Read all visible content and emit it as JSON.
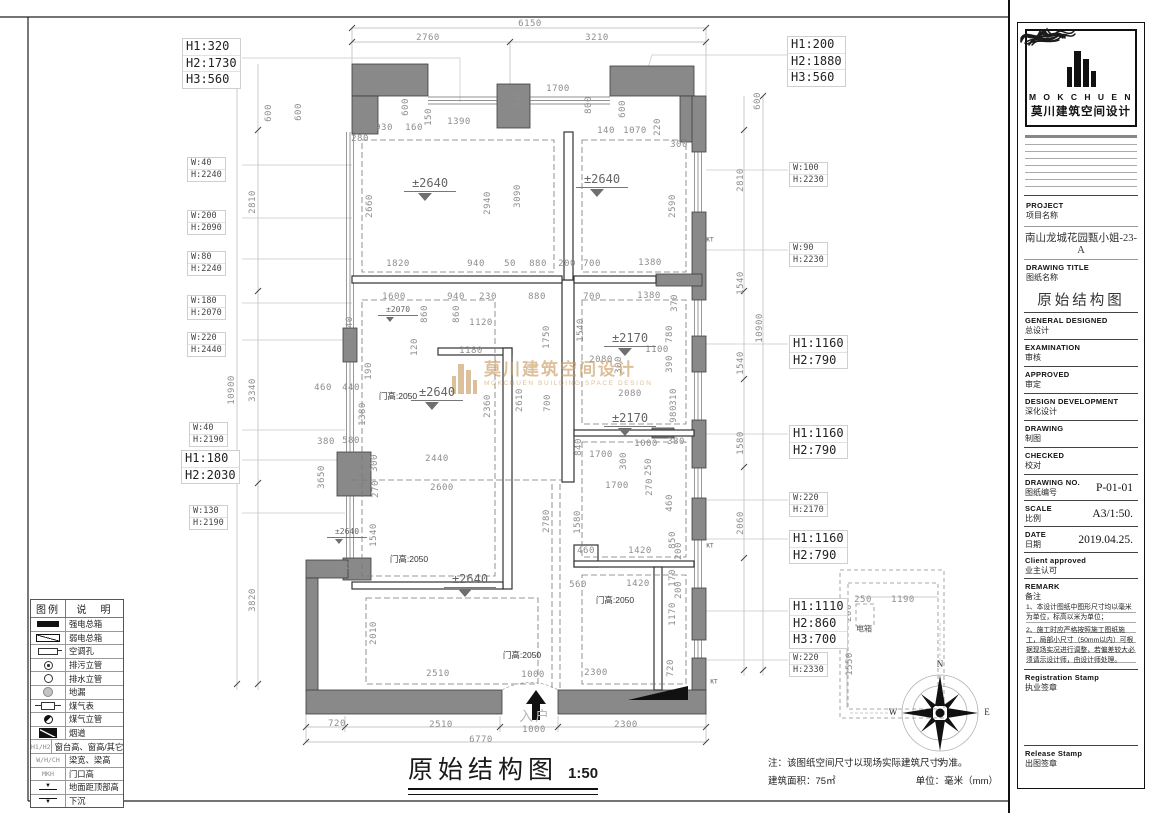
{
  "footer": {
    "title": "原始结构图",
    "scale": "1:50",
    "note": "注：该图纸空间尺寸以现场实际建筑尺寸为准。",
    "area": "建筑面积：75㎡",
    "unit": "单位：毫米（mm）"
  },
  "watermark": {
    "zh": "莫川建筑空间设计",
    "en": "MOKCHUEN BUILDING SPACE DESIGN",
    "color": "#c79b5e"
  },
  "legend": {
    "headers": [
      "图例",
      "说　明"
    ],
    "rows": [
      {
        "sym": "solid",
        "label": "强电总箱"
      },
      {
        "sym": "hatch",
        "label": "弱电总箱"
      },
      {
        "sym": "kt",
        "label": "空调孔"
      },
      {
        "sym": "cdot",
        "label": "排污立管"
      },
      {
        "sym": "c",
        "label": "排水立管"
      },
      {
        "sym": "cgray",
        "label": "地漏"
      },
      {
        "sym": "gas",
        "label": "煤气表"
      },
      {
        "sym": "chalf",
        "label": "煤气立管"
      },
      {
        "sym": "flue",
        "label": "烟道"
      },
      {
        "sym": "text",
        "symtext": "H1/H2",
        "label": "窗台高、窗高/其它"
      },
      {
        "sym": "text",
        "symtext": "W/H/CH",
        "label": "梁宽、梁高"
      },
      {
        "sym": "text",
        "symtext": "MKH",
        "label": "门口高"
      },
      {
        "sym": "lvlup",
        "symtext": "▼",
        "label": "地面距顶部高"
      },
      {
        "sym": "lvldn",
        "symtext": "▼",
        "label": "下沉"
      }
    ]
  },
  "title_block": {
    "brand_en": "M O K C H U E N",
    "brand_zh": "莫川建筑空间设计",
    "project_en": "PROJECT",
    "project_zh": "项目名称",
    "project_value": "南山龙城花园甄小姐-23-A",
    "drawing_title_en": "DRAWING TITLE",
    "drawing_title_zh": "图纸名称",
    "drawing_title_value": "原始结构图",
    "sign_fields": [
      {
        "en": "GENERAL  DESIGNED",
        "zh": "总设计"
      },
      {
        "en": "EXAMINATION",
        "zh": "审核"
      },
      {
        "en": "APPROVED",
        "zh": "审定"
      },
      {
        "en": "DESIGN DEVELOPMENT",
        "zh": "深化设计"
      },
      {
        "en": "DRAWING",
        "zh": "制图"
      },
      {
        "en": "CHECKED",
        "zh": "校对"
      }
    ],
    "drawing_no_en": "DRAWING NO.",
    "drawing_no_zh": "图纸编号",
    "drawing_no_value": "P-01-01",
    "scale_en": "SCALE",
    "scale_zh": "比例",
    "scale_value": "A3/1:50.",
    "date_en": "DATE",
    "date_zh": "日期",
    "date_value": "2019.04.25.",
    "client_en": "Client approved",
    "client_zh": "业主认可",
    "remark_en": "REMARK",
    "remark_zh": "备注",
    "remark_notes": [
      "1、本设计图纸中图形尺寸均以毫米为单位，标高以米为单位；",
      "2、施工时应严格按照施工图纸施工，局部小尺寸（50mm以内）可根据现场实况进行调整，若偏差较大必须请示设计师，由设计师处理。"
    ],
    "registration_en": "Registration Stamp",
    "registration_zh": "执业签章",
    "release_en": "Release Stamp",
    "release_zh": "出图签章"
  },
  "plan": {
    "compass": {
      "n": "N",
      "e": "E",
      "s": "S",
      "w": "W"
    },
    "dims": [
      {
        "t": "6150",
        "x": 530,
        "y": 24
      },
      {
        "t": "2760",
        "x": 428,
        "y": 38
      },
      {
        "t": "3210",
        "x": 597,
        "y": 38
      },
      {
        "t": "600",
        "x": 299,
        "y": 112,
        "r": 1
      },
      {
        "t": "280",
        "x": 360,
        "y": 139
      },
      {
        "t": "930",
        "x": 384,
        "y": 128
      },
      {
        "t": "160",
        "x": 414,
        "y": 128
      },
      {
        "t": "150",
        "x": 429,
        "y": 117,
        "r": 1
      },
      {
        "t": "1390",
        "x": 459,
        "y": 122
      },
      {
        "t": "600",
        "x": 406,
        "y": 107,
        "r": 1
      },
      {
        "t": "520",
        "x": 518,
        "y": 99,
        "r": 1
      },
      {
        "t": "1700",
        "x": 558,
        "y": 89
      },
      {
        "t": "800",
        "x": 589,
        "y": 105,
        "r": 1
      },
      {
        "t": "600",
        "x": 623,
        "y": 109,
        "r": 1
      },
      {
        "t": "140",
        "x": 606,
        "y": 131
      },
      {
        "t": "1070",
        "x": 635,
        "y": 131
      },
      {
        "t": "220",
        "x": 658,
        "y": 127,
        "r": 1
      },
      {
        "t": "300",
        "x": 679,
        "y": 145
      },
      {
        "t": "2660",
        "x": 370,
        "y": 206,
        "r": 1
      },
      {
        "t": "2940",
        "x": 488,
        "y": 203,
        "r": 1
      },
      {
        "t": "3090",
        "x": 518,
        "y": 196,
        "r": 1
      },
      {
        "t": "2590",
        "x": 673,
        "y": 206,
        "r": 1
      },
      {
        "t": "1820",
        "x": 398,
        "y": 264
      },
      {
        "t": "940",
        "x": 476,
        "y": 264
      },
      {
        "t": "50",
        "x": 510,
        "y": 264
      },
      {
        "t": "880",
        "x": 538,
        "y": 264
      },
      {
        "t": "200",
        "x": 567,
        "y": 264
      },
      {
        "t": "700",
        "x": 592,
        "y": 264
      },
      {
        "t": "1380",
        "x": 650,
        "y": 263
      },
      {
        "t": "1600",
        "x": 394,
        "y": 297
      },
      {
        "t": "940",
        "x": 456,
        "y": 297
      },
      {
        "t": "230",
        "x": 488,
        "y": 297
      },
      {
        "t": "880",
        "x": 537,
        "y": 297
      },
      {
        "t": "700",
        "x": 592,
        "y": 297
      },
      {
        "t": "1380",
        "x": 649,
        "y": 296
      },
      {
        "t": "370",
        "x": 675,
        "y": 303,
        "r": 1
      },
      {
        "t": "860",
        "x": 425,
        "y": 314,
        "r": 1
      },
      {
        "t": "860",
        "x": 457,
        "y": 314,
        "r": 1
      },
      {
        "t": "1120",
        "x": 481,
        "y": 323
      },
      {
        "t": "120",
        "x": 415,
        "y": 347,
        "r": 1
      },
      {
        "t": "1180",
        "x": 471,
        "y": 351
      },
      {
        "t": "1440",
        "x": 350,
        "y": 328,
        "r": 1
      },
      {
        "t": "190",
        "x": 369,
        "y": 371,
        "r": 1
      },
      {
        "t": "440",
        "x": 351,
        "y": 388
      },
      {
        "t": "460",
        "x": 323,
        "y": 388
      },
      {
        "t": "1380",
        "x": 363,
        "y": 414,
        "r": 1
      },
      {
        "t": "580",
        "x": 351,
        "y": 441
      },
      {
        "t": "380",
        "x": 326,
        "y": 442
      },
      {
        "t": "2440",
        "x": 437,
        "y": 459
      },
      {
        "t": "300",
        "x": 375,
        "y": 463,
        "r": 1
      },
      {
        "t": "3650",
        "x": 322,
        "y": 477,
        "r": 1
      },
      {
        "t": "2600",
        "x": 442,
        "y": 488
      },
      {
        "t": "270",
        "x": 376,
        "y": 489,
        "r": 1
      },
      {
        "t": "960",
        "x": 343,
        "y": 567
      },
      {
        "t": "1750",
        "x": 547,
        "y": 337,
        "r": 1
      },
      {
        "t": "1540",
        "x": 581,
        "y": 330,
        "r": 1
      },
      {
        "t": "2610",
        "x": 520,
        "y": 400,
        "r": 1
      },
      {
        "t": "2360",
        "x": 488,
        "y": 406,
        "r": 1
      },
      {
        "t": "700",
        "x": 548,
        "y": 403,
        "r": 1
      },
      {
        "t": "2080",
        "x": 601,
        "y": 360
      },
      {
        "t": "1100",
        "x": 657,
        "y": 350
      },
      {
        "t": "300",
        "x": 619,
        "y": 365,
        "r": 1
      },
      {
        "t": "390",
        "x": 670,
        "y": 364,
        "r": 1
      },
      {
        "t": "780",
        "x": 670,
        "y": 334,
        "r": 1
      },
      {
        "t": "2080",
        "x": 630,
        "y": 394
      },
      {
        "t": "310",
        "x": 674,
        "y": 397,
        "r": 1
      },
      {
        "t": "980",
        "x": 674,
        "y": 414,
        "r": 1
      },
      {
        "t": "840",
        "x": 579,
        "y": 447,
        "r": 1
      },
      {
        "t": "1700",
        "x": 601,
        "y": 455
      },
      {
        "t": "1000",
        "x": 646,
        "y": 444
      },
      {
        "t": "300",
        "x": 624,
        "y": 461,
        "r": 1
      },
      {
        "t": "250",
        "x": 649,
        "y": 467,
        "r": 1
      },
      {
        "t": "380",
        "x": 676,
        "y": 442
      },
      {
        "t": "460",
        "x": 670,
        "y": 503,
        "r": 1
      },
      {
        "t": "1700",
        "x": 617,
        "y": 486
      },
      {
        "t": "270",
        "x": 650,
        "y": 487,
        "r": 1
      },
      {
        "t": "560",
        "x": 578,
        "y": 585
      },
      {
        "t": "1420",
        "x": 638,
        "y": 584
      },
      {
        "t": "170",
        "x": 673,
        "y": 578,
        "r": 1
      },
      {
        "t": "1170",
        "x": 673,
        "y": 614,
        "r": 1
      },
      {
        "t": "200",
        "x": 679,
        "y": 590,
        "r": 1
      },
      {
        "t": "460",
        "x": 586,
        "y": 551
      },
      {
        "t": "1420",
        "x": 640,
        "y": 551
      },
      {
        "t": "850",
        "x": 673,
        "y": 540,
        "r": 1
      },
      {
        "t": "200",
        "x": 679,
        "y": 551,
        "r": 1
      },
      {
        "t": "2780",
        "x": 547,
        "y": 521,
        "r": 1
      },
      {
        "t": "1580",
        "x": 578,
        "y": 522,
        "r": 1
      },
      {
        "t": "1540",
        "x": 374,
        "y": 535,
        "r": 1
      },
      {
        "t": "2010",
        "x": 374,
        "y": 633,
        "r": 1
      },
      {
        "t": "2510",
        "x": 438,
        "y": 674
      },
      {
        "t": "1000",
        "x": 533,
        "y": 675
      },
      {
        "t": "2300",
        "x": 596,
        "y": 673
      },
      {
        "t": "720",
        "x": 671,
        "y": 668,
        "r": 1
      },
      {
        "t": "720",
        "x": 337,
        "y": 724
      },
      {
        "t": "2510",
        "x": 441,
        "y": 725
      },
      {
        "t": "1000",
        "x": 534,
        "y": 730
      },
      {
        "t": "2300",
        "x": 626,
        "y": 725
      },
      {
        "t": "6770",
        "x": 481,
        "y": 740
      },
      {
        "t": "600",
        "x": 269,
        "y": 113,
        "r": 1
      },
      {
        "t": "2810",
        "x": 253,
        "y": 202,
        "r": 1
      },
      {
        "t": "3340",
        "x": 253,
        "y": 390,
        "r": 1
      },
      {
        "t": "3820",
        "x": 253,
        "y": 600,
        "r": 1
      },
      {
        "t": "10900",
        "x": 232,
        "y": 390,
        "r": 1
      },
      {
        "t": "600",
        "x": 758,
        "y": 101,
        "r": 1
      },
      {
        "t": "2810",
        "x": 741,
        "y": 180,
        "r": 1
      },
      {
        "t": "1540",
        "x": 741,
        "y": 283,
        "r": 1
      },
      {
        "t": "1540",
        "x": 741,
        "y": 363,
        "r": 1
      },
      {
        "t": "1580",
        "x": 741,
        "y": 443,
        "r": 1
      },
      {
        "t": "2060",
        "x": 741,
        "y": 523,
        "r": 1
      },
      {
        "t": "10900",
        "x": 760,
        "y": 328,
        "r": 1
      },
      {
        "t": "250",
        "x": 863,
        "y": 600
      },
      {
        "t": "1190",
        "x": 903,
        "y": 600
      },
      {
        "t": "200",
        "x": 849,
        "y": 613,
        "r": 1
      },
      {
        "t": "1550",
        "x": 850,
        "y": 664,
        "r": 1
      }
    ],
    "tags": [
      {
        "lines": [
          "H1:320",
          "H2:1730",
          "H3:560"
        ],
        "x": 182,
        "y": 38,
        "big": 1
      },
      {
        "lines": [
          "H1:200",
          "H2:1880",
          "H3:560"
        ],
        "x": 787,
        "y": 36,
        "big": 1
      },
      {
        "lines": [
          "W:40",
          "H:2240"
        ],
        "x": 187,
        "y": 157
      },
      {
        "lines": [
          "W:200",
          "H:2090"
        ],
        "x": 187,
        "y": 210
      },
      {
        "lines": [
          "W:80",
          "H:2240"
        ],
        "x": 187,
        "y": 251
      },
      {
        "lines": [
          "W:180",
          "H:2070"
        ],
        "x": 187,
        "y": 295
      },
      {
        "lines": [
          "W:220",
          "H:2440"
        ],
        "x": 187,
        "y": 332
      },
      {
        "lines": [
          "W:40",
          "H:2190"
        ],
        "x": 189,
        "y": 422
      },
      {
        "lines": [
          "H1:180",
          "H2:2030"
        ],
        "x": 181,
        "y": 450,
        "big": 1
      },
      {
        "lines": [
          "W:130",
          "H:2190"
        ],
        "x": 189,
        "y": 505
      },
      {
        "lines": [
          "W:100",
          "H:2230"
        ],
        "x": 789,
        "y": 162
      },
      {
        "lines": [
          "W:90",
          "H:2230"
        ],
        "x": 789,
        "y": 242
      },
      {
        "lines": [
          "H1:1160",
          "H2:790"
        ],
        "x": 789,
        "y": 335,
        "big": 1
      },
      {
        "lines": [
          "H1:1160",
          "H2:790"
        ],
        "x": 789,
        "y": 425,
        "big": 1
      },
      {
        "lines": [
          "W:220",
          "H:2170"
        ],
        "x": 789,
        "y": 492
      },
      {
        "lines": [
          "H1:1160",
          "H2:790"
        ],
        "x": 789,
        "y": 530,
        "big": 1
      },
      {
        "lines": [
          "H1:1110",
          "H2:860",
          "H3:700"
        ],
        "x": 789,
        "y": 598,
        "big": 1
      },
      {
        "lines": [
          "W:220",
          "H:2330"
        ],
        "x": 789,
        "y": 652
      }
    ],
    "levels": [
      {
        "t": "±2640",
        "x": 430,
        "y": 176
      },
      {
        "t": "±2640",
        "x": 602,
        "y": 172
      },
      {
        "t": "±2640",
        "x": 437,
        "y": 385
      },
      {
        "t": "±2640",
        "x": 470,
        "y": 572
      },
      {
        "t": "±2640",
        "x": 347,
        "y": 527,
        "s": 1
      },
      {
        "t": "±2070",
        "x": 398,
        "y": 305,
        "s": 1
      },
      {
        "t": "±2170",
        "x": 630,
        "y": 331
      },
      {
        "t": "±2170",
        "x": 630,
        "y": 411
      }
    ],
    "doors": [
      {
        "t": "门高:2050",
        "x": 398,
        "y": 396
      },
      {
        "t": "门高:2050",
        "x": 409,
        "y": 559
      },
      {
        "t": "门高:2050",
        "x": 615,
        "y": 600
      },
      {
        "t": "门高:2050",
        "x": 522,
        "y": 655
      }
    ],
    "texts": [
      {
        "t": "入户",
        "x": 535,
        "y": 716,
        "cls": "entry",
        "name": "entrance-label"
      },
      {
        "t": "电箱",
        "x": 864,
        "y": 629,
        "cls": "tiny",
        "name": "electric-box-label"
      },
      {
        "t": "KT",
        "x": 710,
        "y": 240,
        "cls": "kt",
        "name": "ac-hole-label"
      },
      {
        "t": "KT",
        "x": 710,
        "y": 546,
        "cls": "kt",
        "name": "ac-hole-label"
      },
      {
        "t": "KT",
        "x": 714,
        "y": 682,
        "cls": "kt",
        "name": "ac-hole-label"
      }
    ]
  }
}
